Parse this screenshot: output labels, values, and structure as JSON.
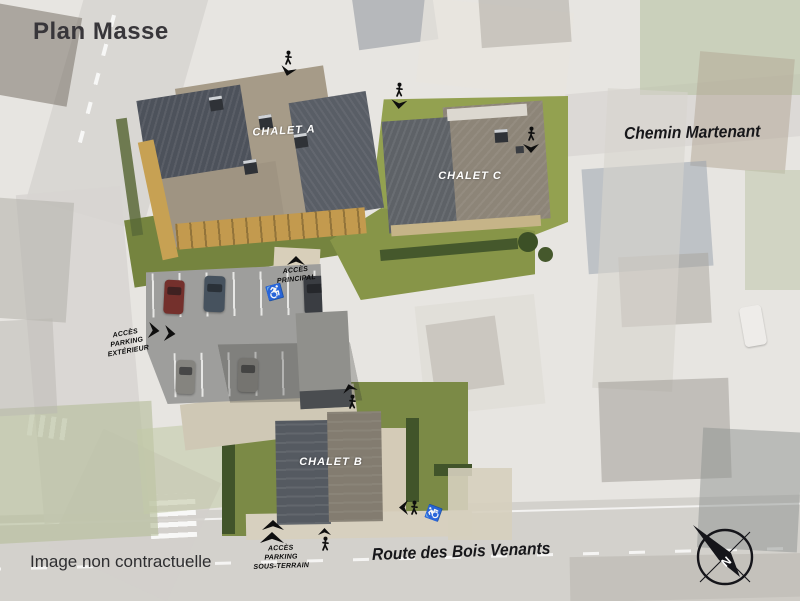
{
  "page": {
    "title": "Plan Masse",
    "disclaimer": "Image non contractuelle"
  },
  "streets": {
    "chemin_martenant": "Chemin Martenant",
    "route_des_bois_venants": "Route des Bois Venants"
  },
  "chalets": {
    "a": {
      "label": "CHALET A"
    },
    "b": {
      "label": "CHALET B"
    },
    "c": {
      "label": "CHALET C"
    }
  },
  "access": {
    "principal": {
      "lines": [
        "ACCÈS",
        "PRINCIPAL"
      ]
    },
    "parking_exterieur": {
      "lines": [
        "ACCÈS",
        "PARKING",
        "EXTÉRIEUR"
      ]
    },
    "parking_sous_terrain": {
      "lines": [
        "ACCÈS",
        "PARKING",
        "SOUS-TERRAIN"
      ]
    }
  },
  "compass": {
    "north": "N"
  },
  "icons": {
    "wheelchair": "♿",
    "pedestrian": "walking-person-icon",
    "access_arrow": "filled-chevron-arrow-icon",
    "compass": "north-compass-icon"
  },
  "colors": {
    "lawn": "#7b8a46",
    "hedge": "#41542a",
    "asphalt": "#9e9e9c",
    "wood_balcony": "#c39a4e",
    "roof_dark": "#53585f",
    "roof_warm": "#a69b88",
    "road": "#d2d0cb",
    "ink": "#161616",
    "label_white": "#ffffff"
  }
}
